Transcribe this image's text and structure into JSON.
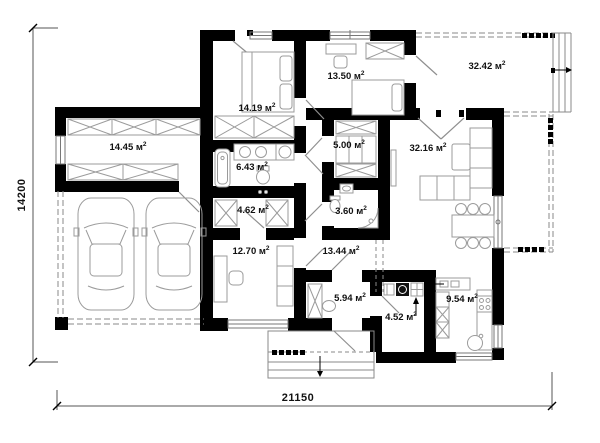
{
  "plan_type": "single-storey house floor plan",
  "rooms": [
    {
      "name": "storage-garage-room",
      "label": "14.45 м",
      "sup": "2"
    },
    {
      "name": "bedroom-1",
      "label": "14.19 м",
      "sup": "2"
    },
    {
      "name": "bedroom-2",
      "label": "13.50 м",
      "sup": "2"
    },
    {
      "name": "terrace-top",
      "label": "32.42 м",
      "sup": "2"
    },
    {
      "name": "wardrobe",
      "label": "5.00 м",
      "sup": "2"
    },
    {
      "name": "living-room",
      "label": "32.16 м",
      "sup": "2"
    },
    {
      "name": "bathroom",
      "label": "6.43 м",
      "sup": "2"
    },
    {
      "name": "closet",
      "label": "4.62 м",
      "sup": "2"
    },
    {
      "name": "wc",
      "label": "3.60 м",
      "sup": "2"
    },
    {
      "name": "office",
      "label": "12.70 м",
      "sup": "2"
    },
    {
      "name": "hallway",
      "label": "13.44 м",
      "sup": "2"
    },
    {
      "name": "entry",
      "label": "5.94 м",
      "sup": "2"
    },
    {
      "name": "laundry",
      "label": "4.52 м",
      "sup": "2"
    },
    {
      "name": "kitchen",
      "label": "9.54 м",
      "sup": "2"
    }
  ],
  "dimensions": {
    "vertical": "14200",
    "horizontal": "21150"
  },
  "colors": {
    "wall": "#000000",
    "furniture_stroke": "#9b9b9b",
    "dash": "#8a8a8a",
    "window": "#777777",
    "door_leaf": "#8f8f8f",
    "dimension_line": "#555555",
    "text": "#111111",
    "background": "#ffffff"
  }
}
